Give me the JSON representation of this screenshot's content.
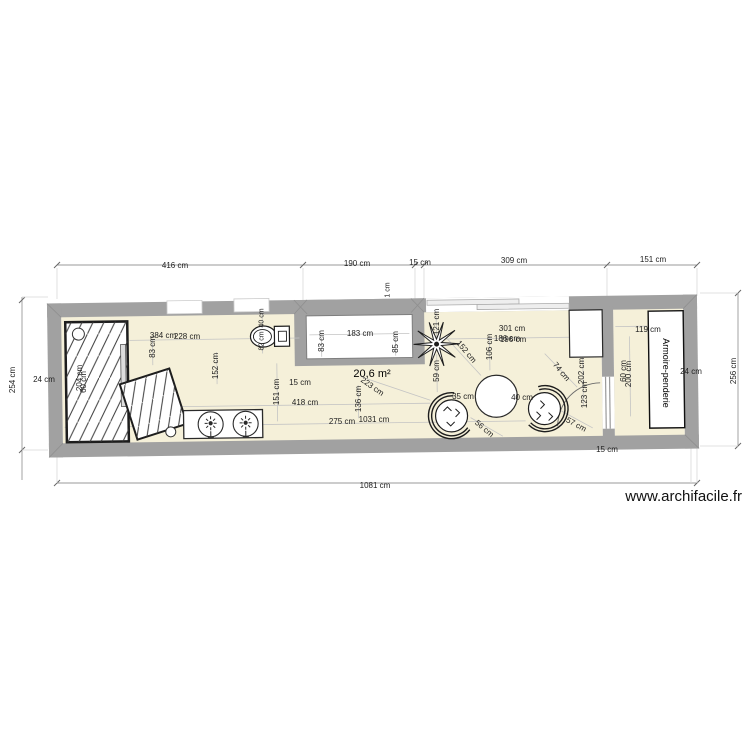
{
  "watermark": "www.archifacile.fr",
  "plan": {
    "area_label": "20,6 m²",
    "wardrobe_label": "Armoire-penderie"
  },
  "colors": {
    "wall": "#a1a1a1",
    "floor": "#f5f0d9",
    "fixture_outline": "#222222",
    "dim_line": "#c4c4c4",
    "outer_dim_line": "#999999"
  },
  "icons": [
    {
      "name": "faucet-icon",
      "glyph": "sun-burst with spout"
    },
    {
      "name": "plant-icon",
      "glyph": "spiky star"
    },
    {
      "name": "drain-icon",
      "glyph": "small circle"
    }
  ],
  "dim_labels": [
    {
      "t": "416 cm",
      "x": 175,
      "y": 266
    },
    {
      "t": "190 cm",
      "x": 357,
      "y": 264
    },
    {
      "t": "15 cm",
      "x": 420,
      "y": 263
    },
    {
      "t": "309 cm",
      "x": 514,
      "y": 261
    },
    {
      "t": "151 cm",
      "x": 653,
      "y": 260
    },
    {
      "t": "254 cm",
      "x": 13,
      "y": 380,
      "r": -90
    },
    {
      "t": "256 cm",
      "x": 734,
      "y": 371,
      "r": -90
    },
    {
      "t": "1081 cm",
      "x": 375,
      "y": 486
    },
    {
      "t": "24 cm",
      "x": 44,
      "y": 380
    },
    {
      "t": "24 cm",
      "x": 691,
      "y": 372
    },
    {
      "t": "15 cm",
      "x": 607,
      "y": 450
    },
    {
      "t": "384 cm",
      "x": 163,
      "y": 336
    },
    {
      "t": "228 cm",
      "x": 187,
      "y": 337
    },
    {
      "t": "83 cm",
      "x": 153,
      "y": 347,
      "r": -90
    },
    {
      "t": "152 cm",
      "x": 216,
      "y": 366,
      "r": -90
    },
    {
      "t": "151 cm",
      "x": 277,
      "y": 392,
      "r": -90
    },
    {
      "t": "15 cm",
      "x": 300,
      "y": 383
    },
    {
      "t": "418 cm",
      "x": 305,
      "y": 403
    },
    {
      "t": "275 cm",
      "x": 342,
      "y": 422
    },
    {
      "t": "1031 cm",
      "x": 374,
      "y": 420
    },
    {
      "t": "136 cm",
      "x": 359,
      "y": 399,
      "r": -90
    },
    {
      "t": "223 cm",
      "x": 372,
      "y": 387,
      "r": 35
    },
    {
      "t": "183 cm",
      "x": 360,
      "y": 334
    },
    {
      "t": "83 cm",
      "x": 322,
      "y": 341,
      "r": -90
    },
    {
      "t": "85 cm",
      "x": 396,
      "y": 342,
      "r": -90
    },
    {
      "t": "1 cm",
      "x": 388,
      "y": 290,
      "r": -90,
      "fs": 7
    },
    {
      "t": "121 cm",
      "x": 437,
      "y": 322,
      "r": -90
    },
    {
      "t": "59 cm",
      "x": 437,
      "y": 371,
      "r": -90
    },
    {
      "t": "152 cm",
      "x": 466,
      "y": 352,
      "r": 50
    },
    {
      "t": "106 cm",
      "x": 490,
      "y": 347,
      "r": -90
    },
    {
      "t": "301 cm",
      "x": 512,
      "y": 329
    },
    {
      "t": "186 cm",
      "x": 507,
      "y": 339
    },
    {
      "t": "196 cm",
      "x": 513,
      "y": 340
    },
    {
      "t": "35 cm",
      "x": 463,
      "y": 397
    },
    {
      "t": "40 cm",
      "x": 522,
      "y": 398
    },
    {
      "t": "56 cm",
      "x": 484,
      "y": 429,
      "r": 40
    },
    {
      "t": "74 cm",
      "x": 561,
      "y": 372,
      "r": 50
    },
    {
      "t": "57 cm",
      "x": 576,
      "y": 425,
      "r": 28
    },
    {
      "t": "204 cm",
      "x": 80,
      "y": 378,
      "r": -90
    },
    {
      "t": "60 cm",
      "x": 84,
      "y": 382,
      "r": -90
    },
    {
      "t": "40 cm",
      "x": 262,
      "y": 318,
      "r": -90,
      "fs": 7
    },
    {
      "t": "82 cm",
      "x": 262,
      "y": 341,
      "r": -90,
      "fs": 7
    },
    {
      "t": "119 cm",
      "x": 648,
      "y": 330
    },
    {
      "t": "60 cm",
      "x": 624,
      "y": 371,
      "r": -90
    },
    {
      "t": "200 cm",
      "x": 629,
      "y": 374,
      "r": -90
    },
    {
      "t": "202 cm",
      "x": 582,
      "y": 371,
      "r": -90
    },
    {
      "t": "123 cm",
      "x": 585,
      "y": 395,
      "r": -90
    }
  ]
}
